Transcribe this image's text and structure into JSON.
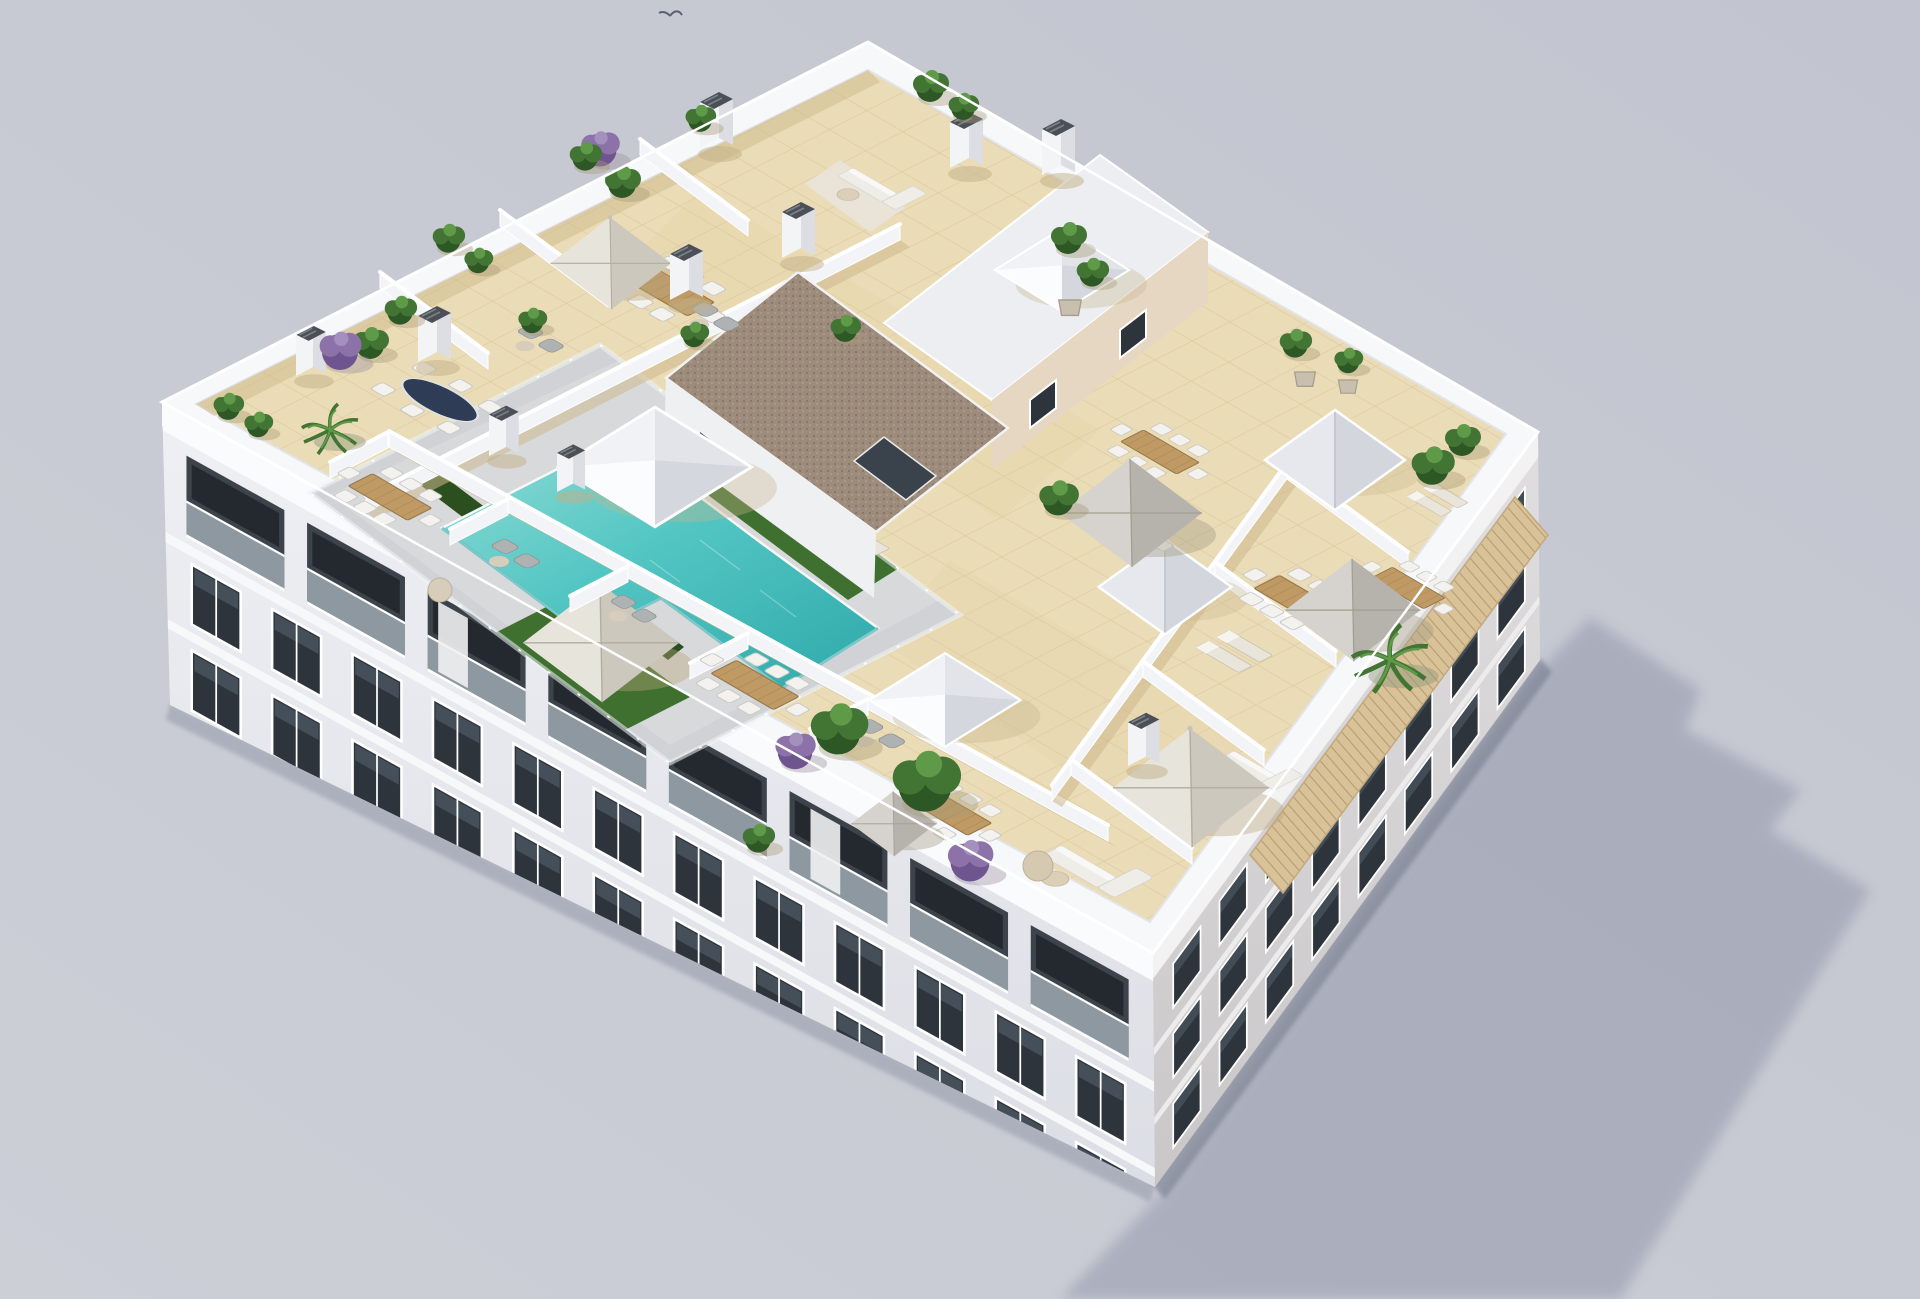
{
  "meta": {
    "type": "3d-architectural-render",
    "view": "aerial-isometric",
    "subject": "new-build apartment block rooftop solarium with communal pool and private terraces",
    "background": "plain studio gray"
  },
  "colors": {
    "bg1": "#cdcfd7",
    "bg2": "#c2c4cf",
    "shadow": "#8f94a8",
    "contact": "#6e7487",
    "facade": "#eff0f4",
    "facadeShade": "#dcdee5",
    "facadeRight": "#e0dedf",
    "facadeRightShade": "#cac7c9",
    "parapet": "#f7f8fa",
    "wall": "#f3f4f7",
    "wallShade": "#e0e2e8",
    "tile": "#eadcb6",
    "tileLine": "#dcc9a0",
    "tileShade": "#cdb88c",
    "deck": "#d0d2d5",
    "deckLight": "#dfe0e2",
    "pool": "#53c6c3",
    "poolLight": "#93dcd6",
    "poolDeep": "#2fa9ab",
    "grass": "#3f7030",
    "grassLight": "#548c3c",
    "hedge": "#2c4f20",
    "wood": "#bf9a64",
    "woodDark": "#9a7a4c",
    "window": "#2e343b",
    "windowLight": "#5c6a77",
    "recess": "#3d434b",
    "glassRail": "#c3d2d8",
    "umbrella": "#ddd8cd",
    "umbrellaGray": "#cbc7c0",
    "sofa": "#efede8",
    "brownRoof": "#9d8b7c",
    "brownDot": "#887565",
    "beigeWall": "#e6d7c3",
    "skylightDark": "#3a424b",
    "chimneyCap": "#4b5057",
    "plantDark": "#2d5724",
    "plantMid": "#427434",
    "plantLight": "#5f9a48",
    "purple": "#6f5590",
    "purpleLight": "#8c72a8",
    "pot": "#c8bfae",
    "pergola": "#d9c298",
    "pergolaLine": "#b59c71",
    "bird": "#5a6170",
    "white": "#ffffff"
  },
  "objects": [
    {
      "name": "swimming-pool",
      "count": 1
    },
    {
      "name": "pool-glass-fence",
      "count": 1
    },
    {
      "name": "pyramid-skylight",
      "count": 3
    },
    {
      "name": "v-shaped-skylight",
      "count": 2
    },
    {
      "name": "stair-core-gravel-roof",
      "count": 1
    },
    {
      "name": "parasol",
      "count": 6
    },
    {
      "name": "dining-set",
      "count": 8
    },
    {
      "name": "glass-dining-table",
      "count": 1
    },
    {
      "name": "sun-lounger",
      "count": 10
    },
    {
      "name": "sofa-set",
      "count": 3
    },
    {
      "name": "armchair-set",
      "count": 4
    },
    {
      "name": "chimney-vent",
      "count": 10
    },
    {
      "name": "planter-plant",
      "count": 26
    },
    {
      "name": "purple-bougainvillea",
      "count": 4
    },
    {
      "name": "tiled-awning",
      "count": 1
    },
    {
      "name": "bird",
      "count": 1
    }
  ]
}
